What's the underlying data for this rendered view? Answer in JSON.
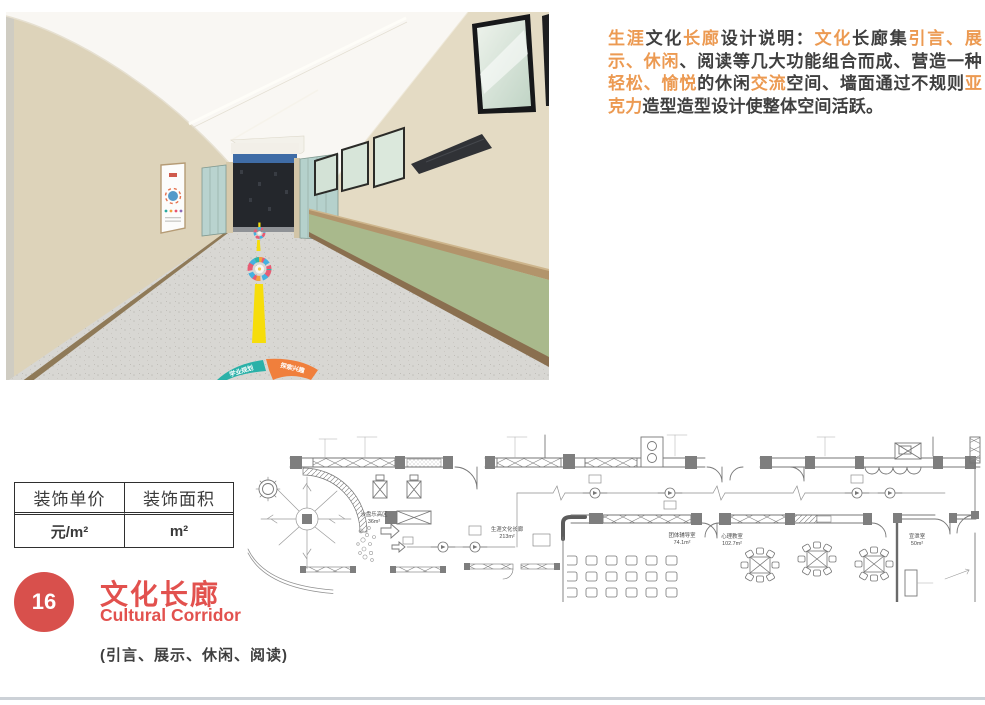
{
  "page": {
    "background": "#ffffff",
    "bottom_rule_color": "#ccd1d7"
  },
  "description": {
    "orange_color": "#ec9a52",
    "dark_color": "#3f3f3f",
    "segments": [
      {
        "text": "生涯",
        "tone": "o"
      },
      {
        "text": "文化",
        "tone": "d"
      },
      {
        "text": "长廊",
        "tone": "o"
      },
      {
        "text": "设计说明：",
        "tone": "d"
      },
      {
        "text": "文化",
        "tone": "o"
      },
      {
        "text": "长廊集",
        "tone": "d"
      },
      {
        "text": "引言、展示、休闲",
        "tone": "o"
      },
      {
        "text": "、阅读等几大功能组合而成、营造一种",
        "tone": "d"
      },
      {
        "text": "轻松、愉悦",
        "tone": "o"
      },
      {
        "text": "的休闲",
        "tone": "d"
      },
      {
        "text": "交流",
        "tone": "o"
      },
      {
        "text": "空间、墙面通过不规则",
        "tone": "d"
      },
      {
        "text": "亚克力",
        "tone": "o"
      },
      {
        "text": "造型造型设计使整体空间活跃。",
        "tone": "d"
      }
    ]
  },
  "photo": {
    "subject": "文化长廊效果图",
    "floor_graphic_labels": [
      "学业规划",
      "探索兴趣"
    ],
    "colors": {
      "left_wall": "#ddd3ba",
      "green_wall": "#a9b98c",
      "wood_trim": "#b2946b",
      "ceiling": "#f9f7f3",
      "floor": "#d8d7d3",
      "guide_line_yellow": "#f6dd0a",
      "wedge_teal": "#2ab1a8",
      "wedge_orange": "#f07f3c"
    }
  },
  "cost_table": {
    "headers": [
      "装饰单价",
      "装饰面积"
    ],
    "values": [
      "元/m²",
      "m²"
    ]
  },
  "section": {
    "number": "16",
    "title": "文化长廊",
    "subtitle": "Cultural Corridor",
    "note": "(引言、展示、休闲、阅读)",
    "badge_color": "#d8504c",
    "title_color": "#e2514e"
  },
  "floorplan": {
    "rooms": [
      {
        "name": "沙盘乐高区",
        "area": "36m²"
      },
      {
        "name": "生涯文化长廊",
        "area": "213m²"
      },
      {
        "name": "团体辅导室",
        "area": "74.1m²"
      },
      {
        "name": "心理教室",
        "area": "102.7m²"
      },
      {
        "name": "宣泄室",
        "area": "50m²"
      }
    ]
  }
}
